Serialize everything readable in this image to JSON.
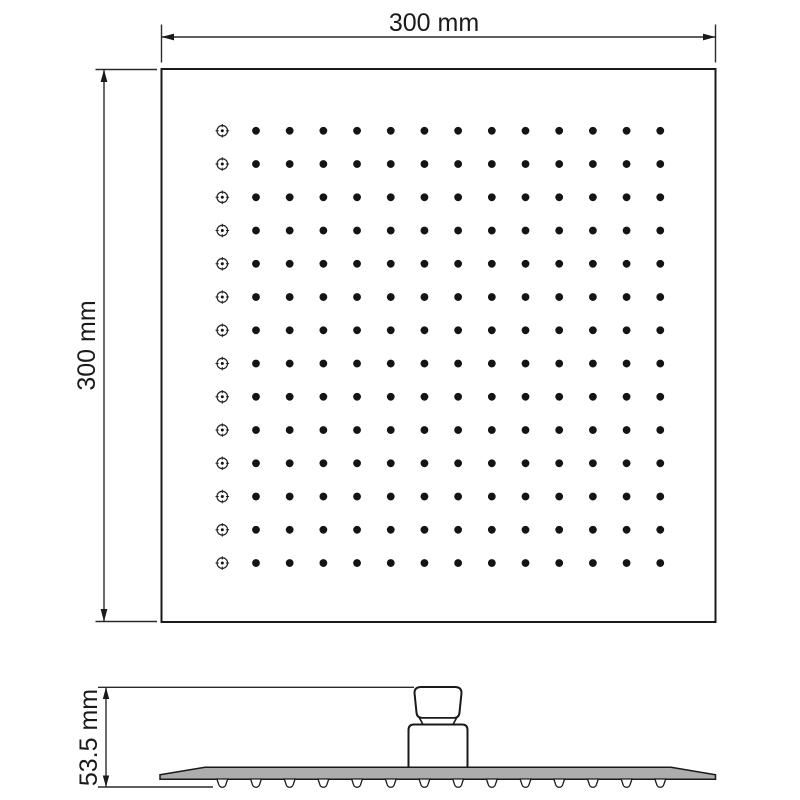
{
  "drawing": {
    "type": "technical-dimension-drawing",
    "subject": "square-rain-shower-head",
    "dimensions": {
      "width_label": "300 mm",
      "height_label": "300 mm",
      "side_height_label": "53.5 mm"
    },
    "front_view": {
      "grid": {
        "rows": 14,
        "cols": 14,
        "first_column_glyph": "crosshair-nozzle",
        "other_columns_glyph": "filled-nozzle-dot"
      }
    },
    "side_view": {
      "nozzle_count": 14,
      "parts": [
        "inlet-fitting",
        "collar-nut",
        "connector-base",
        "shower-plate",
        "nozzle-tips"
      ]
    }
  },
  "colors": {
    "background": "#ffffff",
    "outline": "#1a1a1a",
    "dimension_line": "#2a2a2a",
    "slab_fill": "#adadad",
    "nozzle_dot": "#141414"
  },
  "geometry": {
    "front_grid": {
      "x0": 222.3,
      "y0": 130.8,
      "dx": 33.69,
      "dy": 33.25
    },
    "side_nozzles": {
      "x0": 222.3,
      "dx": 33.69,
      "y_top": 779
    }
  }
}
